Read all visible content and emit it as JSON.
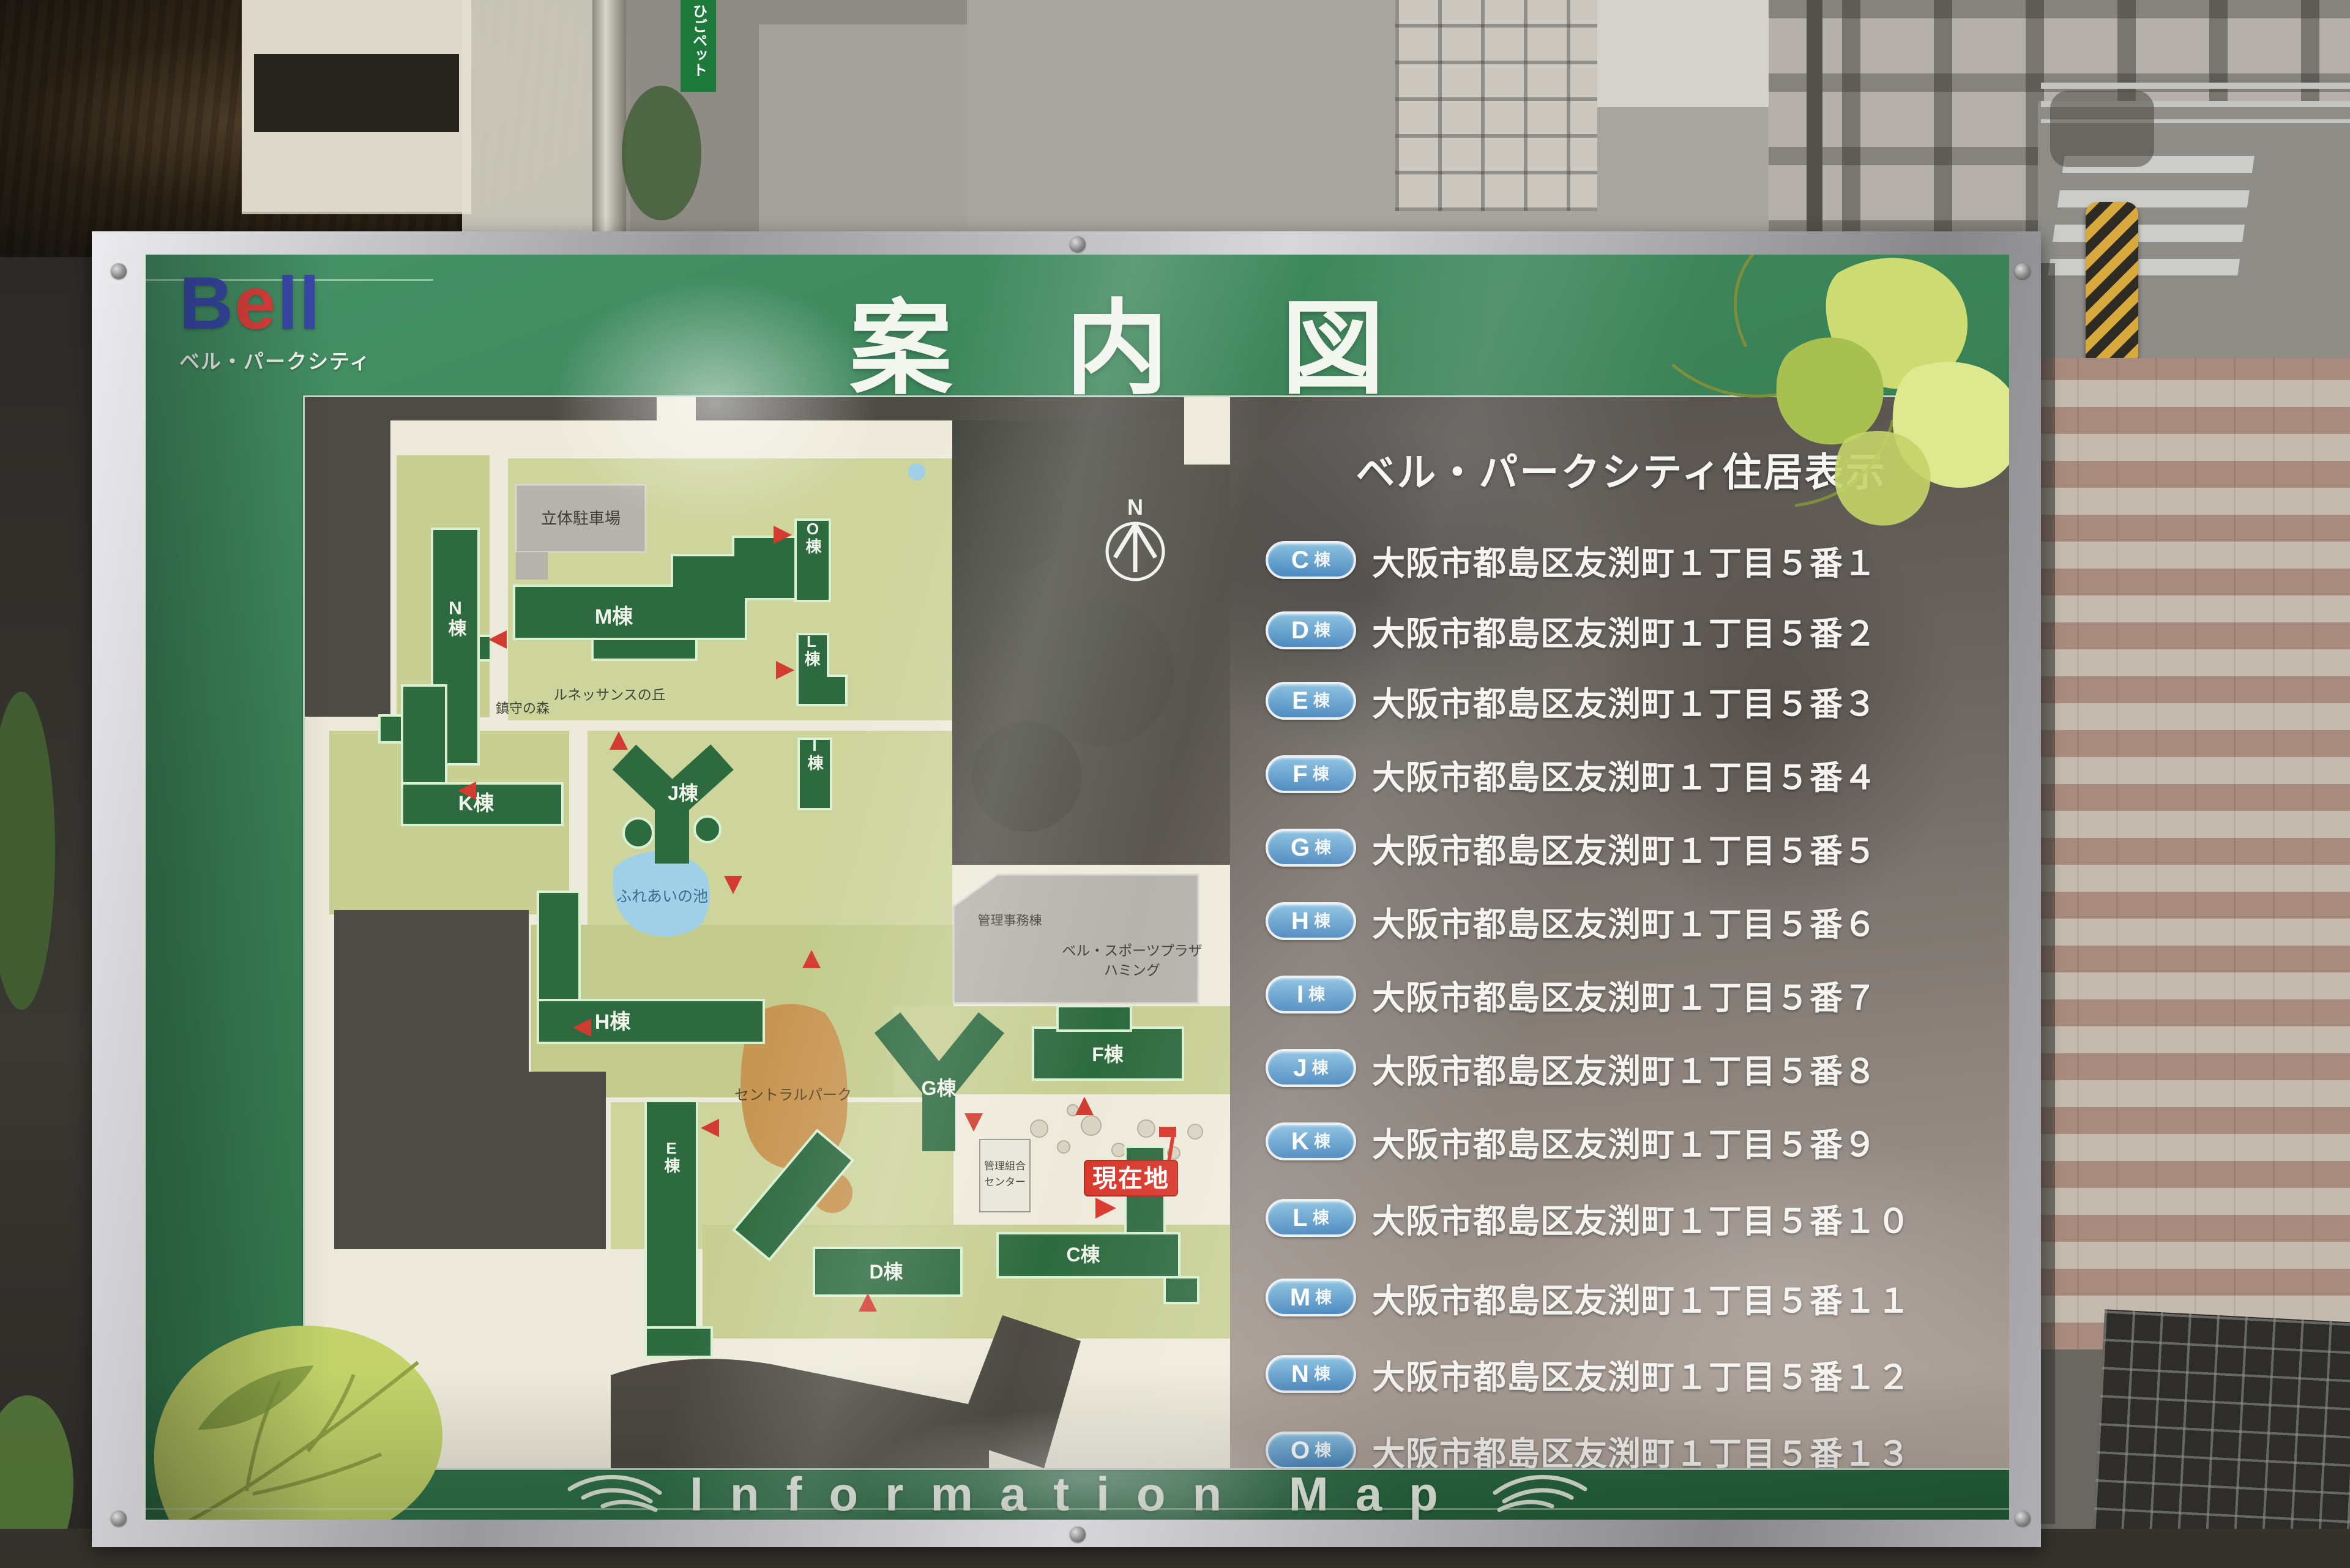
{
  "sign": {
    "logo": {
      "b": "B",
      "e": "e",
      "ll": "ll",
      "subtitle": "ベル・パークシティ"
    },
    "title": "案内図",
    "footer_text": "Information Map"
  },
  "map": {
    "labels": {
      "north": "N",
      "parking": "立体駐車場",
      "shrine_grove": "鎮守の森",
      "renaissance_hill": "ルネッサンスの丘",
      "pond": "ふれあいの池",
      "central_park": "セントラルパーク",
      "sports_plaza_line1": "ベル・スポーツプラザ",
      "sports_plaza_line2": "ハミング",
      "admin_office": "管理事務棟",
      "union_center_line1": "管理組合",
      "union_center_line2": "センター",
      "you_are_here": "現在地",
      "bldg_c": "C棟",
      "bldg_d": "D棟",
      "bldg_e": "E棟",
      "bldg_f": "F棟",
      "bldg_g": "G棟",
      "bldg_h": "H棟",
      "bldg_i": "I棟",
      "bldg_j": "J棟",
      "bldg_k": "K棟",
      "bldg_l": "L棟",
      "bldg_m": "M棟",
      "bldg_n": "N棟",
      "bldg_o": "O棟"
    }
  },
  "directory": {
    "title": "ベル・パークシティ住居表示",
    "rows": [
      {
        "letter": "C",
        "suffix": "棟",
        "address": "大阪市都島区友渕町１丁目５番１"
      },
      {
        "letter": "D",
        "suffix": "棟",
        "address": "大阪市都島区友渕町１丁目５番２"
      },
      {
        "letter": "E",
        "suffix": "棟",
        "address": "大阪市都島区友渕町１丁目５番３"
      },
      {
        "letter": "F",
        "suffix": "棟",
        "address": "大阪市都島区友渕町１丁目５番４"
      },
      {
        "letter": "G",
        "suffix": "棟",
        "address": "大阪市都島区友渕町１丁目５番５"
      },
      {
        "letter": "H",
        "suffix": "棟",
        "address": "大阪市都島区友渕町１丁目５番６"
      },
      {
        "letter": "I",
        "suffix": "棟",
        "address": "大阪市都島区友渕町１丁目５番７"
      },
      {
        "letter": "J",
        "suffix": "棟",
        "address": "大阪市都島区友渕町１丁目５番８"
      },
      {
        "letter": "K",
        "suffix": "棟",
        "address": "大阪市都島区友渕町１丁目５番９"
      },
      {
        "letter": "L",
        "suffix": "棟",
        "address": "大阪市都島区友渕町１丁目５番１０"
      },
      {
        "letter": "M",
        "suffix": "棟",
        "address": "大阪市都島区友渕町１丁目５番１１"
      },
      {
        "letter": "N",
        "suffix": "棟",
        "address": "大阪市都島区友渕町１丁目５番１２"
      },
      {
        "letter": "O",
        "suffix": "棟",
        "address": "大阪市都島区友渕町１丁目５番１３"
      }
    ]
  },
  "street": {
    "shop_sign": "ひごペット"
  },
  "colors": {
    "sign_green": "#3c8159",
    "badge_blue": "#4f93cc",
    "marker_red": "#d23c30",
    "building_green": "#2d6a3f",
    "you_are_here_red": "#d8372b",
    "pond_blue": "#9fd0e8",
    "park_tan": "#c89653",
    "map_cream": "#eeeadb",
    "lawn_green": "#c7cf93"
  }
}
